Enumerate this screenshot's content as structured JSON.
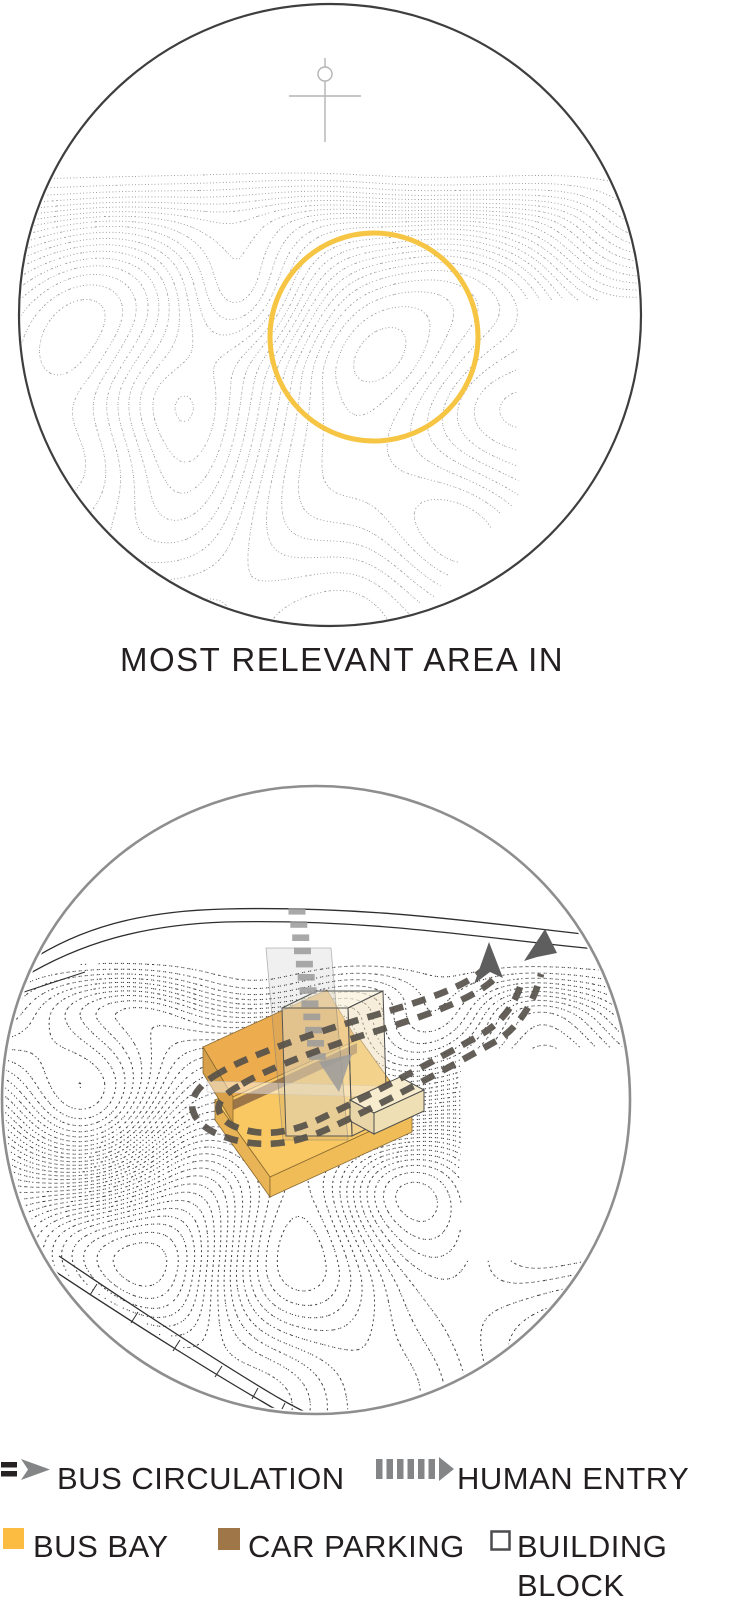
{
  "caption": "MOST RELEVANT AREA IN",
  "legend": {
    "items": [
      {
        "id": "bus-circulation",
        "label": "BUS CIRCULATION"
      },
      {
        "id": "human-entry",
        "label": "HUMAN ENTRY"
      },
      {
        "id": "bus-bay",
        "label": "BUS BAY"
      },
      {
        "id": "car-parking",
        "label": "CAR PARKING"
      },
      {
        "id": "building-block",
        "label": "BUILDING BLOCK"
      }
    ]
  },
  "colors": {
    "highlight_circle": "#F7C544",
    "bus_bay": "#FBBC41",
    "car_parking": "#9E7647",
    "building_block_border": "#4C4C4E",
    "arrow_gray": "#838587",
    "dash_dark": "#262223",
    "bus_route": "#57524B",
    "text": "#231F20"
  }
}
